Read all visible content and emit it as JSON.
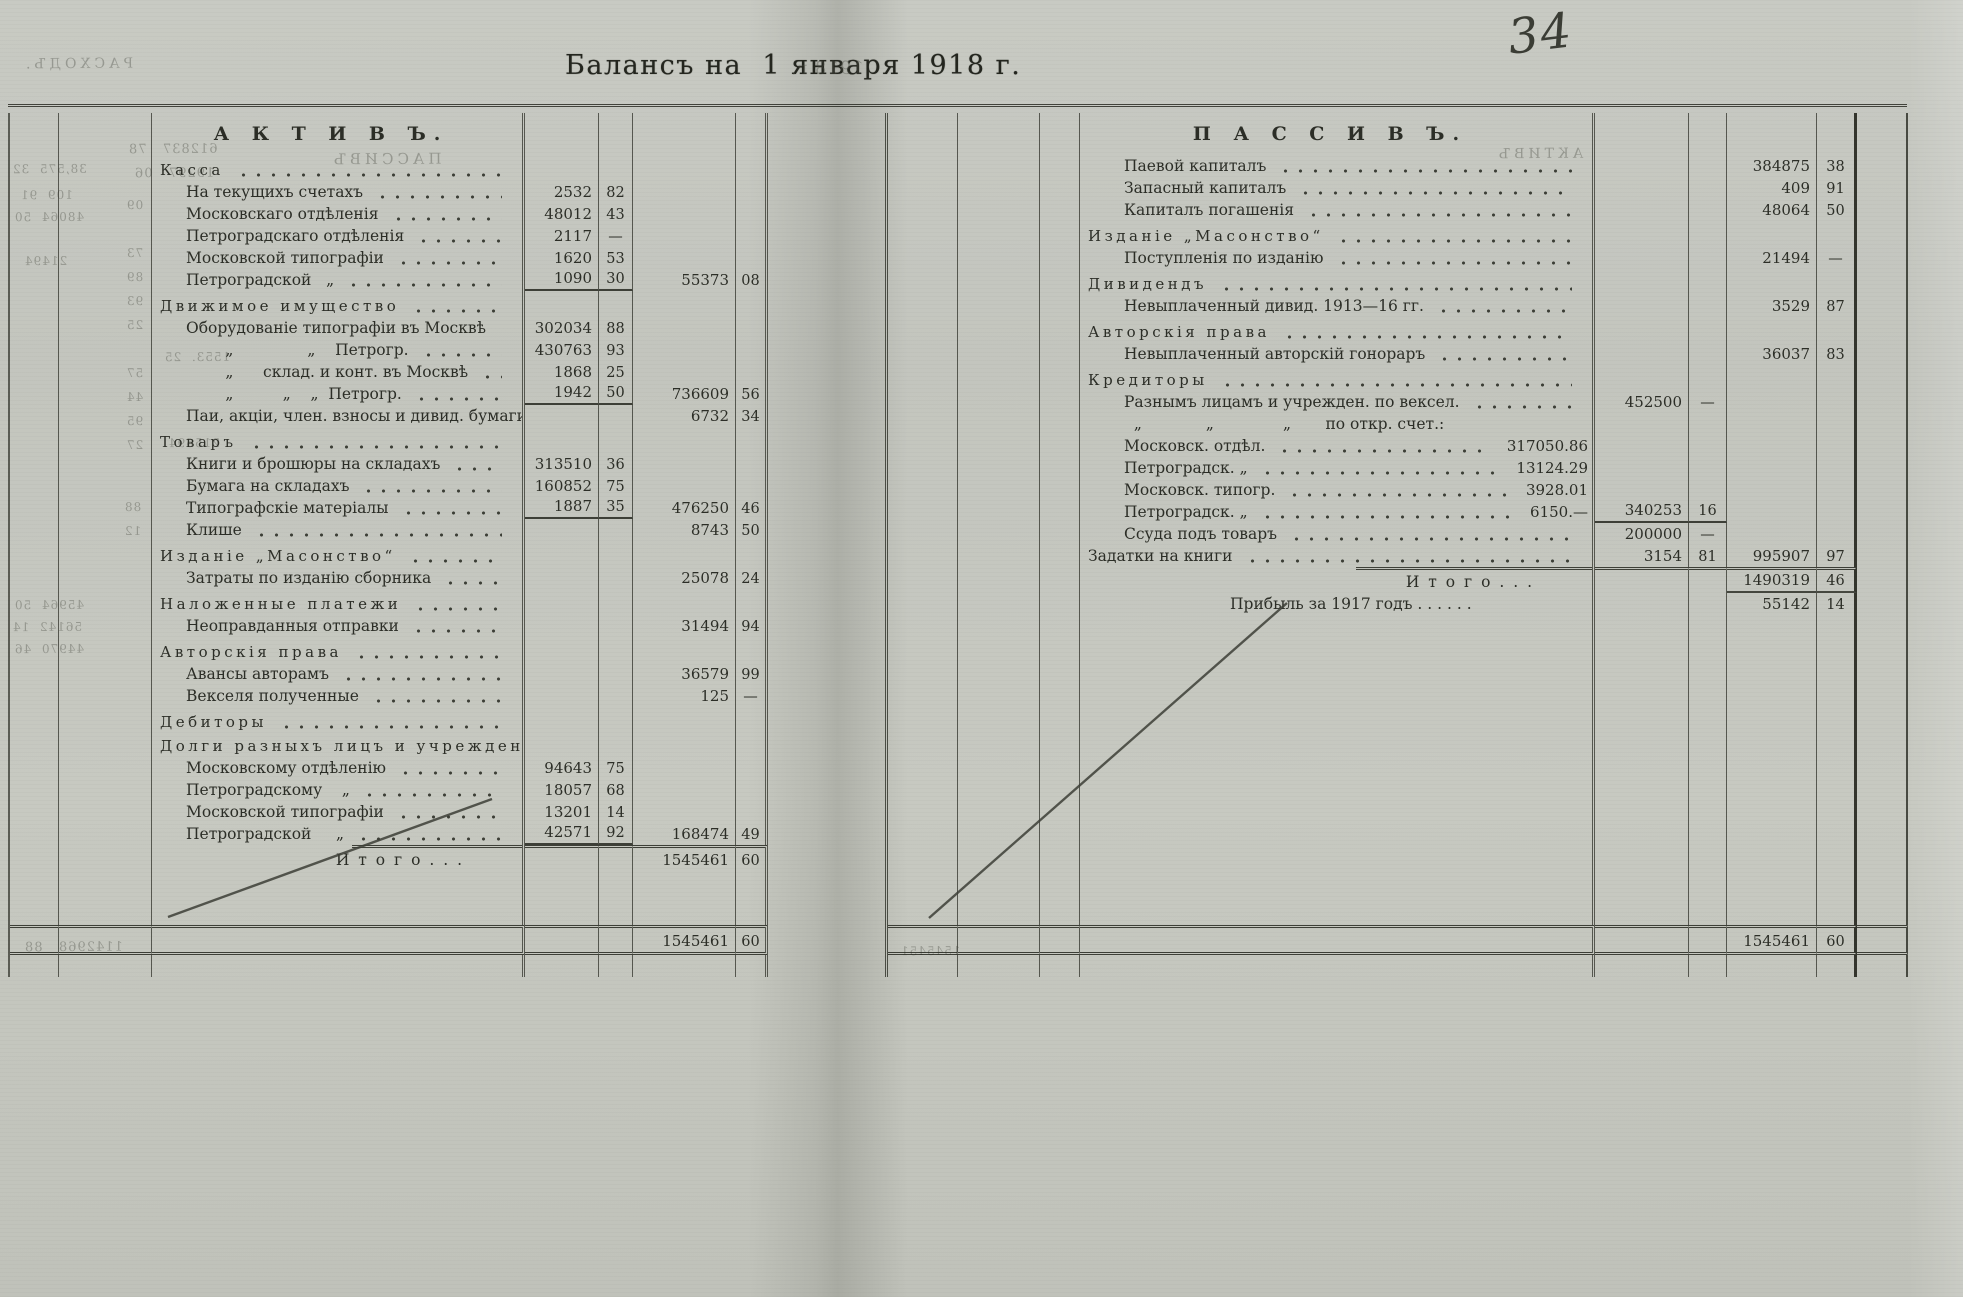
{
  "document": {
    "title": "Балансъ на  1 января 1918 г.",
    "page_number": "34"
  },
  "active_page": {
    "rows": [
      {
        "cls": "title",
        "label": "А К Т И В Ъ."
      },
      {
        "cls": "section",
        "label": "Касса"
      },
      {
        "cls": "item",
        "label": "На текущихъ счетахъ",
        "a1": "2532",
        "k1": "82"
      },
      {
        "cls": "item",
        "label": "Московскаго отдѣленія",
        "a1": "48012",
        "k1": "43"
      },
      {
        "cls": "item",
        "label": "Петроградскаго отдѣленія",
        "a1": "2117",
        "k1": "—"
      },
      {
        "cls": "item",
        "label": "Московской типографіи",
        "a1": "1620",
        "k1": "53"
      },
      {
        "cls": "item rule1",
        "label": "Петроградской   „",
        "a1": "1090",
        "k1": "30",
        "a2": "55373",
        "k2": "08"
      },
      {
        "cls": "section",
        "label": "Движимое имущество"
      },
      {
        "cls": "item",
        "label": "Оборудованіе типографіи въ Москвѣ",
        "a1": "302034",
        "k1": "88"
      },
      {
        "cls": "item",
        "label": "        „               „    Петрогр.",
        "a1": "430763",
        "k1": "93"
      },
      {
        "cls": "item",
        "label": "        „      склад. и конт. въ Москвѣ",
        "a1": "1868",
        "k1": "25"
      },
      {
        "cls": "item rule1",
        "label": "        „          „    „  Петрогр.",
        "a1": "1942",
        "k1": "50",
        "a2": "736609",
        "k2": "56"
      },
      {
        "cls": "item",
        "label": "Паи, акціи, член. взносы и дивид. бумаги",
        "a2": "6732",
        "k2": "34"
      },
      {
        "cls": "section",
        "label": "Товаръ"
      },
      {
        "cls": "item",
        "label": "Книги и брошюры на складахъ",
        "a1": "313510",
        "k1": "36"
      },
      {
        "cls": "item",
        "label": "Бумага на складахъ",
        "a1": "160852",
        "k1": "75"
      },
      {
        "cls": "item rule1",
        "label": "Типографскіе матеріалы",
        "a1": "1887",
        "k1": "35",
        "a2": "476250",
        "k2": "46"
      },
      {
        "cls": "item",
        "label": "Клише",
        "a2": "8743",
        "k2": "50"
      },
      {
        "cls": "section",
        "label": "Изданіе „Масонство“"
      },
      {
        "cls": "item",
        "label": "Затраты по изданію сборника",
        "a2": "25078",
        "k2": "24"
      },
      {
        "cls": "section",
        "label": "Наложенные платежи"
      },
      {
        "cls": "item",
        "label": "Неоправданныя отправки",
        "a2": "31494",
        "k2": "94"
      },
      {
        "cls": "section",
        "label": "Авторскія права"
      },
      {
        "cls": "item",
        "label": "Авансы авторамъ",
        "a2": "36579",
        "k2": "99"
      },
      {
        "cls": "item",
        "label": "Векселя полученные",
        "a2": "125",
        "k2": "—"
      },
      {
        "cls": "section",
        "label": "Дебиторы"
      },
      {
        "cls": "section sub",
        "label": "Долги разныхъ лицъ и учрежденій:"
      },
      {
        "cls": "item",
        "label": "Московскому отдѣленію",
        "a1": "94643",
        "k1": "75"
      },
      {
        "cls": "item",
        "label": "Петроградскому    „",
        "a1": "18057",
        "k1": "68"
      },
      {
        "cls": "item",
        "label": "Московской типографіи",
        "a1": "13201",
        "k1": "14"
      },
      {
        "cls": "item rule1",
        "label": "Петроградской     „",
        "a1": "42571",
        "k1": "92",
        "a2": "168474",
        "k2": "49"
      },
      {
        "cls": "totals",
        "label": "И т о г о . . .",
        "a2": "1545461",
        "k2": "60"
      },
      {
        "cls": "spacer"
      },
      {
        "cls": "bottomrow",
        "a2": "1545461",
        "k2": "60"
      },
      {
        "cls": "tail"
      }
    ]
  },
  "passive_page": {
    "rows": [
      {
        "cls": "title",
        "label": "П А С С И В Ъ."
      },
      {
        "cls": "item",
        "label": "Паевой капиталъ",
        "a2": "384875",
        "k2": "38"
      },
      {
        "cls": "item",
        "label": "Запасный капиталъ",
        "a2": "409",
        "k2": "91"
      },
      {
        "cls": "item",
        "label": "Капиталъ погашенія",
        "a2": "48064",
        "k2": "50"
      },
      {
        "cls": "section",
        "label": "Изданіе „Масонство“"
      },
      {
        "cls": "item",
        "label": "Поступленія по изданію",
        "a2": "21494",
        "k2": "—"
      },
      {
        "cls": "section",
        "label": "Дивидендъ"
      },
      {
        "cls": "item",
        "label": "Невыплаченный дивид. 1913—16 гг.",
        "a2": "3529",
        "k2": "87"
      },
      {
        "cls": "section",
        "label": "Авторскія права"
      },
      {
        "cls": "item",
        "label": "Невыплаченный авторскій гонораръ",
        "a2": "36037",
        "k2": "83"
      },
      {
        "cls": "section",
        "label": "Кредиторы"
      },
      {
        "cls": "item",
        "label": "Разнымъ лицамъ и учрежден. по вексел.",
        "a1": "452500",
        "k1": "—"
      },
      {
        "cls": "item nodots",
        "label": "  „             „              „       по откр. счет.:"
      },
      {
        "cls": "item",
        "label": "Московск. отдѣл.",
        "in": "317050.86"
      },
      {
        "cls": "item",
        "label": "Петроградск. „",
        "in": "13124.29"
      },
      {
        "cls": "item",
        "label": "Московск. типогр.",
        "in": "3928.01"
      },
      {
        "cls": "item rule1",
        "label": "Петроградск. „",
        "in": "6150.—",
        "a1": "340253",
        "k1": "16"
      },
      {
        "cls": "item",
        "label": "Ссуда подъ товаръ",
        "a1": "200000",
        "k1": "—"
      },
      {
        "cls": "item low",
        "label": "Задатки на книги",
        "a1": "3154",
        "k1": "81",
        "a2": "995907",
        "k2": "97"
      },
      {
        "cls": "totals ruleb",
        "label": "И т о г о . . .",
        "a2": "1490319",
        "k2": "46"
      },
      {
        "cls": "item center nodots",
        "label": "Прибыль за 1917 годъ . . . . . .",
        "a2": "55142",
        "k2": "14"
      },
      {
        "cls": "spacer"
      },
      {
        "cls": "bottomrow",
        "a2": "1545461",
        "k2": "60"
      },
      {
        "cls": "tail"
      }
    ]
  },
  "ghosts": [
    {
      "text": "РАСХОДЪ.",
      "x": 22,
      "y": 56,
      "size": 14,
      "sp": 4
    },
    {
      "text": "1918 г.",
      "x": 790,
      "y": 58,
      "size": 18
    },
    {
      "text": "612837   78",
      "x": 128,
      "y": 142,
      "size": 13
    },
    {
      "text": "19297   06",
      "x": 134,
      "y": 166,
      "size": 13
    },
    {
      "text": "ПАССИВЪ",
      "x": 330,
      "y": 150,
      "size": 15,
      "sp": 4
    },
    {
      "text": "38,575  32",
      "x": 12,
      "y": 162,
      "size": 12
    },
    {
      "text": "109  91",
      "x": 20,
      "y": 188,
      "size": 12
    },
    {
      "text": "48064  50",
      "x": 14,
      "y": 210,
      "size": 12
    },
    {
      "text": "21494",
      "x": 24,
      "y": 254,
      "size": 12
    },
    {
      "text": "09",
      "x": 126,
      "y": 198,
      "size": 12
    },
    {
      "text": "73",
      "x": 126,
      "y": 246,
      "size": 12
    },
    {
      "text": "89",
      "x": 126,
      "y": 270,
      "size": 12
    },
    {
      "text": "93",
      "x": 126,
      "y": 294,
      "size": 12
    },
    {
      "text": "25",
      "x": 126,
      "y": 318,
      "size": 12
    },
    {
      "text": "57",
      "x": 126,
      "y": 366,
      "size": 12
    },
    {
      "text": "44",
      "x": 126,
      "y": 390,
      "size": 12
    },
    {
      "text": "95",
      "x": 126,
      "y": 414,
      "size": 12
    },
    {
      "text": "27",
      "x": 126,
      "y": 438,
      "size": 12
    },
    {
      "text": "1553.  25",
      "x": 164,
      "y": 350,
      "size": 12
    },
    {
      "text": "215694",
      "x": 168,
      "y": 436,
      "size": 12
    },
    {
      "text": "88",
      "x": 124,
      "y": 500,
      "size": 12
    },
    {
      "text": "12",
      "x": 124,
      "y": 524,
      "size": 12
    },
    {
      "text": "45964  50",
      "x": 14,
      "y": 598,
      "size": 12
    },
    {
      "text": "56142  14",
      "x": 12,
      "y": 620,
      "size": 12
    },
    {
      "text": "44970  46",
      "x": 14,
      "y": 642,
      "size": 12
    },
    {
      "text": "1142968   88",
      "x": 24,
      "y": 940,
      "size": 13
    },
    {
      "text": "АКТИВЪ",
      "x": 1495,
      "y": 146,
      "size": 14,
      "sp": 4
    },
    {
      "text": "1545451",
      "x": 900,
      "y": 944,
      "size": 12
    }
  ]
}
